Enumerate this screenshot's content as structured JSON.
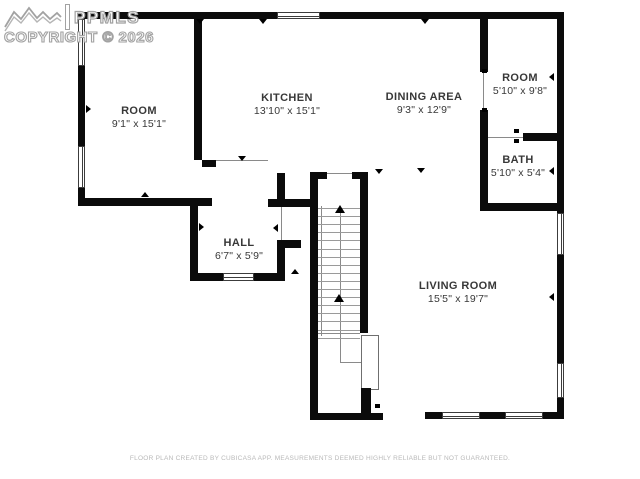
{
  "watermark": {
    "brand": "PPMLS",
    "copyright": "COPYRIGHT © 2026",
    "logo_icon": "mountain-range-icon"
  },
  "footer": {
    "disclaimer": "FLOOR PLAN CREATED BY CUBICASA APP. MEASUREMENTS DEEMED HIGHLY RELIABLE BUT NOT GUARANTEED."
  },
  "rooms": {
    "room_top_left": {
      "name": "ROOM",
      "dims": "9'1\" x 15'1\""
    },
    "kitchen": {
      "name": "KITCHEN",
      "dims": "13'10\" x 15'1\""
    },
    "dining": {
      "name": "DINING AREA",
      "dims": "9'3\" x 12'9\""
    },
    "room_top_right": {
      "name": "ROOM",
      "dims": "5'10\" x 9'8\""
    },
    "bath": {
      "name": "BATH",
      "dims": "5'10\" x 5'4\""
    },
    "hall": {
      "name": "HALL",
      "dims": "6'7\" x 5'9\""
    },
    "living": {
      "name": "LIVING ROOM",
      "dims": "15'5\" x 19'7\""
    }
  },
  "stairs": {
    "direction_icon": "up-arrow-icon"
  },
  "colors": {
    "wall": "#0b0b0b",
    "label_text": "#383838",
    "watermark_gray": "#a2a2a2",
    "disclaimer_gray": "#b9b9b9",
    "thin_line": "#8a8a8a"
  }
}
